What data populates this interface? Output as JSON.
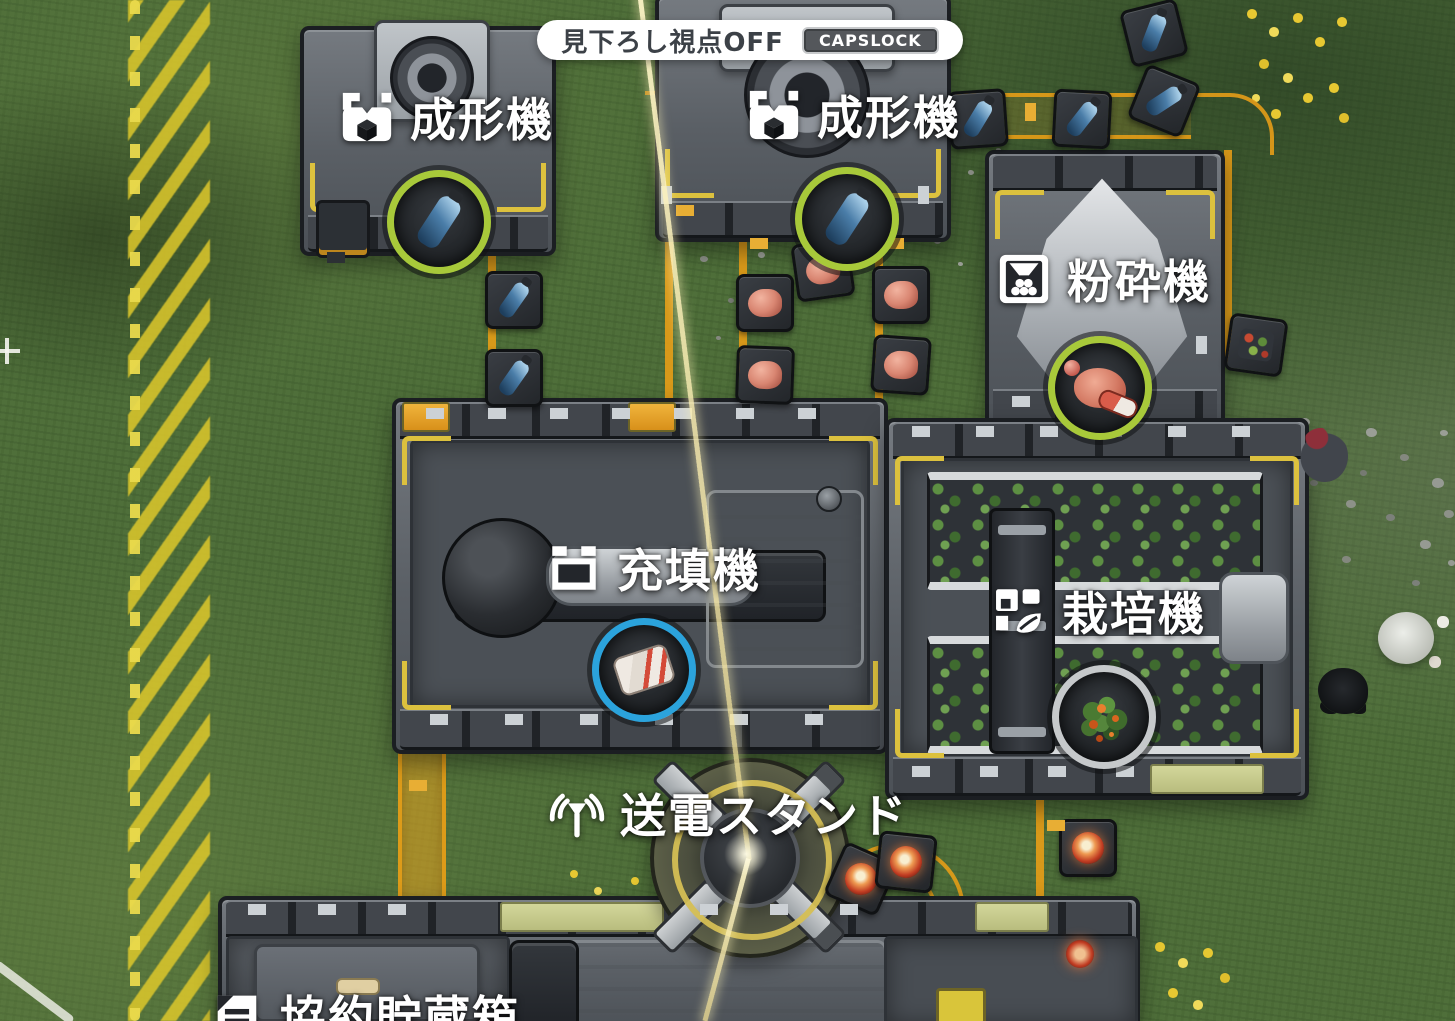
{
  "hud": {
    "banner_text": "見下ろし視点OFF",
    "banner_key": "CAPSLOCK"
  },
  "machine_labels": [
    {
      "name": "molding-machine-1",
      "icon": "molder-icon",
      "text": "成形機"
    },
    {
      "name": "molding-machine-2",
      "icon": "molder-icon",
      "text": "成形機"
    },
    {
      "name": "crusher",
      "icon": "crusher-icon",
      "text": "粉砕機"
    },
    {
      "name": "filling-machine",
      "icon": "filler-icon",
      "text": "充填機"
    },
    {
      "name": "cultivator",
      "icon": "cultivator-icon",
      "text": "栽培機"
    },
    {
      "name": "power-stand",
      "icon": "antenna-icon",
      "text": "送電スタンド"
    },
    {
      "name": "contract-storage",
      "icon": "storage-icon",
      "text": "協約貯蔵箱"
    }
  ],
  "item_markers": [
    {
      "machine": "molding-machine-1",
      "item": "water-bottle",
      "ring_color": "#a8c93a"
    },
    {
      "machine": "molding-machine-2",
      "item": "water-bottle",
      "ring_color": "#a8c93a"
    },
    {
      "machine": "crusher",
      "item": "red-powder-and-capsule",
      "ring_color": "#a8c93a"
    },
    {
      "machine": "filling-machine",
      "item": "sealed-ration-pack",
      "ring_color": "#2ba3dc"
    },
    {
      "machine": "cultivator",
      "item": "berry-plant",
      "ring_color": "#c6c9cb"
    }
  ],
  "belt_trays": [
    {
      "item": "water-bottle",
      "x": 511,
      "y": 297,
      "rot": 0
    },
    {
      "item": "water-bottle",
      "x": 511,
      "y": 375,
      "rot": 0
    },
    {
      "item": "water-bottle",
      "x": 975,
      "y": 116,
      "rot": -4
    },
    {
      "item": "water-bottle",
      "x": 1079,
      "y": 116,
      "rot": 3
    },
    {
      "item": "water-bottle",
      "x": 1161,
      "y": 98,
      "rot": 22
    },
    {
      "item": "water-bottle",
      "x": 1151,
      "y": 30,
      "rot": -14
    },
    {
      "item": "meat-chunk",
      "x": 762,
      "y": 300,
      "rot": 0
    },
    {
      "item": "meat-chunk",
      "x": 762,
      "y": 372,
      "rot": 2
    },
    {
      "item": "meat-chunk",
      "x": 820,
      "y": 267,
      "rot": -8
    },
    {
      "item": "meat-chunk",
      "x": 898,
      "y": 292,
      "rot": 0
    },
    {
      "item": "meat-chunk",
      "x": 898,
      "y": 362,
      "rot": 4
    },
    {
      "item": "seed-mix",
      "x": 1253,
      "y": 342,
      "rot": 8
    },
    {
      "item": "red-lamp-fruit",
      "x": 858,
      "y": 876,
      "rot": 24
    },
    {
      "item": "red-lamp-fruit",
      "x": 903,
      "y": 859,
      "rot": 6
    },
    {
      "item": "red-lamp-fruit",
      "x": 1085,
      "y": 845,
      "rot": 0
    }
  ],
  "colors": {
    "conveyor_orange": "#e09a18",
    "hazard_yellow": "#ddc63a",
    "grass_green": "#4f6f3a",
    "ring_green": "#a8c93a",
    "ring_blue": "#2ba3dc",
    "ring_gray": "#c6c9cb",
    "banner_bg": "#ffffff",
    "banner_text": "#3c4147",
    "keycap_bg": "#54575b"
  }
}
